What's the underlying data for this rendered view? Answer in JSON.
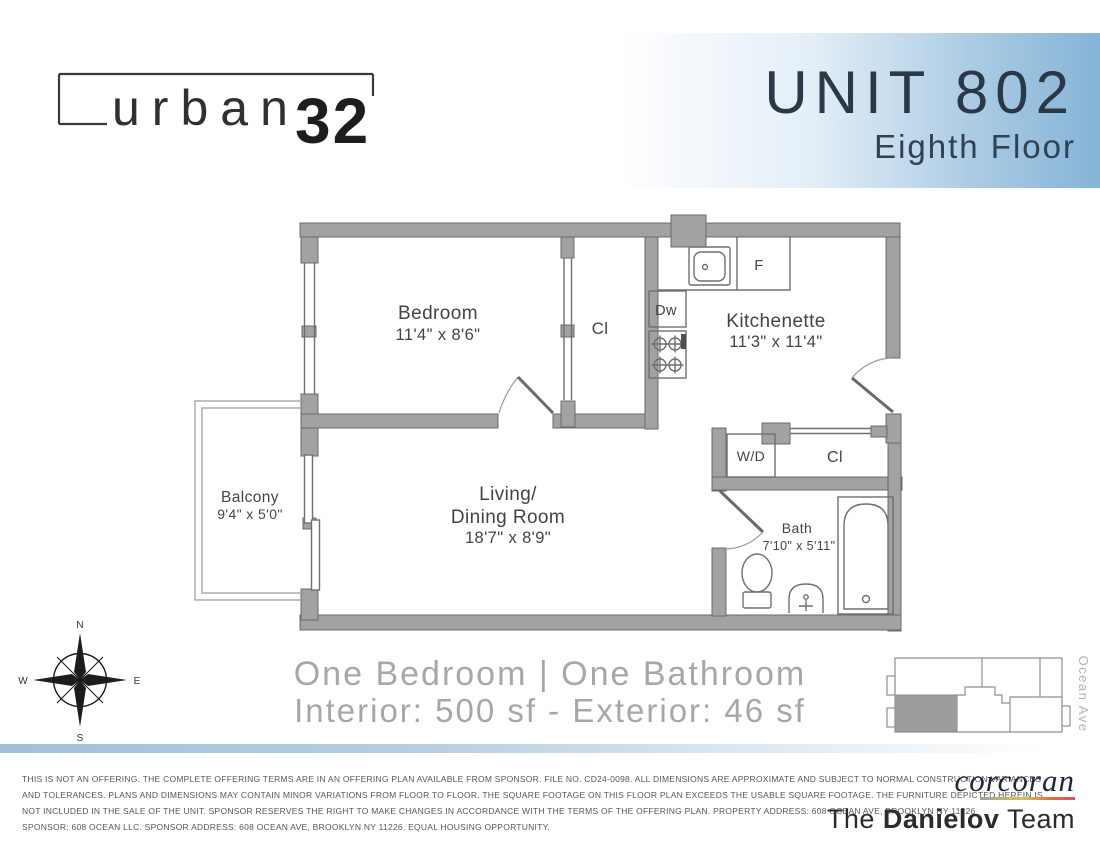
{
  "header": {
    "logo_word": "urban",
    "logo_number": "32",
    "unit": "UNIT 802",
    "floor": "Eighth Floor"
  },
  "plan": {
    "bedroom": {
      "name": "Bedroom",
      "dims": "11'4\" x 8'6\""
    },
    "closet1": {
      "name": "Cl"
    },
    "kitchenette": {
      "name": "Kitchenette",
      "dims": "11'3\" x 11'4\""
    },
    "fridge": {
      "name": "F"
    },
    "dishwasher": {
      "name": "Dw"
    },
    "washer_dryer": {
      "name": "W/D"
    },
    "closet2": {
      "name": "Cl"
    },
    "bath": {
      "name": "Bath",
      "dims": "7'10\" x 5'11\""
    },
    "living": {
      "l1": "Living/",
      "l2": "Dining Room",
      "dims": "18'7\" x 8'9\""
    },
    "balcony": {
      "name": "Balcony",
      "dims": "9'4\" x 5'0\""
    }
  },
  "compass": {
    "n": "N",
    "e": "E",
    "s": "S",
    "w": "W"
  },
  "summary": {
    "l1": "One Bedroom | One Bathroom",
    "l2": "Interior: 500 sf - Exterior: 46 sf"
  },
  "keyplan": {
    "street": "Ocean Ave"
  },
  "footer": {
    "lines": [
      "THIS IS NOT AN OFFERING. THE COMPLETE OFFERING TERMS ARE IN AN OFFERING PLAN AVAILABLE FROM SPONSOR. FILE NO. CD24-0098. ALL DIMENSIONS ARE APPROXIMATE AND SUBJECT TO NORMAL CONSTRUCTION VARIANCES",
      "AND TOLERANCES. PLANS AND DIMENSIONS MAY CONTAIN MINOR VARIATIONS FROM FLOOR TO FLOOR. THE SQUARE FOOTAGE ON THIS FLOOR PLAN EXCEEDS THE USABLE SQUARE FOOTAGE. THE FURNITURE DEPICTED HEREIN IS",
      "NOT INCLUDED IN THE SALE OF THE UNIT. SPONSOR RESERVES THE RIGHT TO MAKE CHANGES IN ACCORDANCE WITH THE TERMS OF THE OFFERING PLAN. PROPERTY ADDRESS: 608 OCEAN AVE, BROOKLYN NY 11226",
      "SPONSOR: 608 OCEAN LLC. SPONSOR ADDRESS: 608 OCEAN AVE, BROOKLYN NY 11226. EQUAL HOUSING OPPORTUNITY."
    ],
    "brand": "corcoran",
    "team_pre": "The ",
    "team_bold": "Danielov",
    "team_post": " Team"
  },
  "colors": {
    "header_blue": "#85b4d8",
    "title_navy": "#2a3847",
    "wall_gray": "#a2a2a2",
    "label_gray": "#444444",
    "summary_gray": "#a7a7a7",
    "brand_navy": "#23263a",
    "rainbow": [
      "#93a79c",
      "#d8c167",
      "#e0703f",
      "#d94f63"
    ]
  }
}
